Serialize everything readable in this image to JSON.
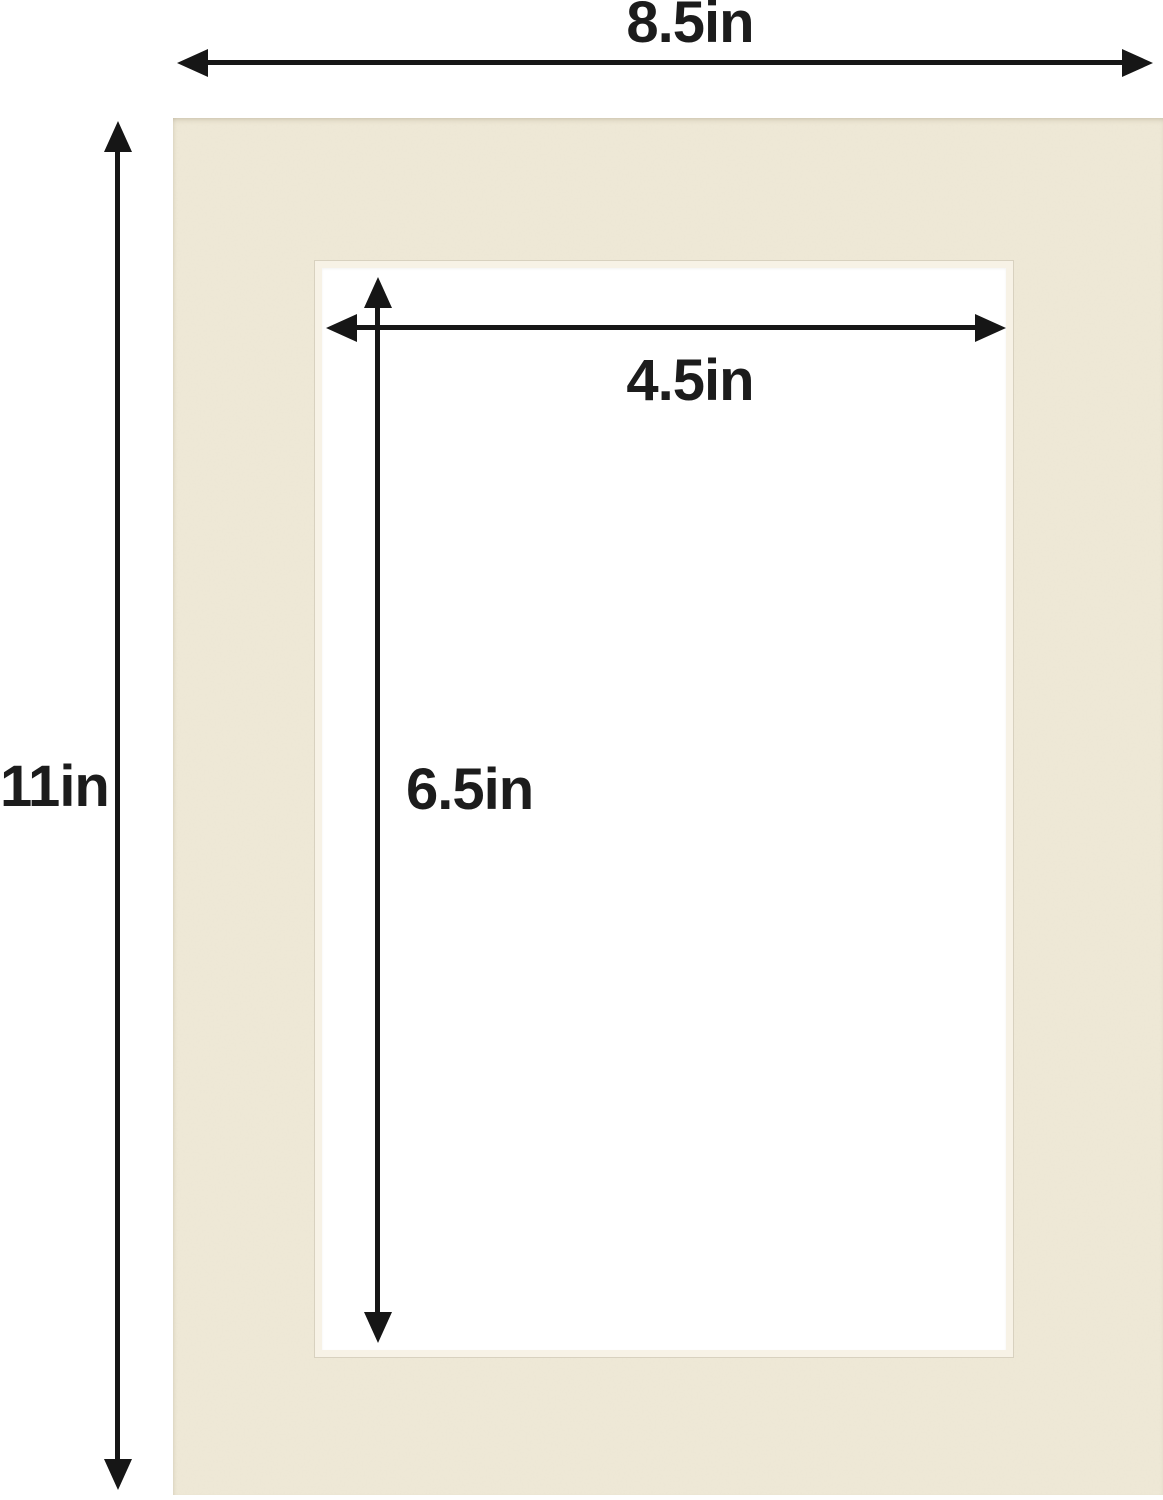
{
  "diagram": {
    "outer": {
      "width_label": "8.5in",
      "height_label": "11in"
    },
    "opening": {
      "width_label": "4.5in",
      "height_label": "6.5in"
    },
    "measurements": {
      "outer_width_in": 8.5,
      "outer_height_in": 11,
      "opening_width_in": 4.5,
      "opening_height_in": 6.5
    }
  },
  "colors": {
    "mat": "#efe9d7",
    "mat_bevel": "#f7f2e6",
    "bevel_line": "#d8d1bf",
    "arrow": "#161616",
    "label": "#1c1c1c",
    "background": "#ffffff"
  }
}
